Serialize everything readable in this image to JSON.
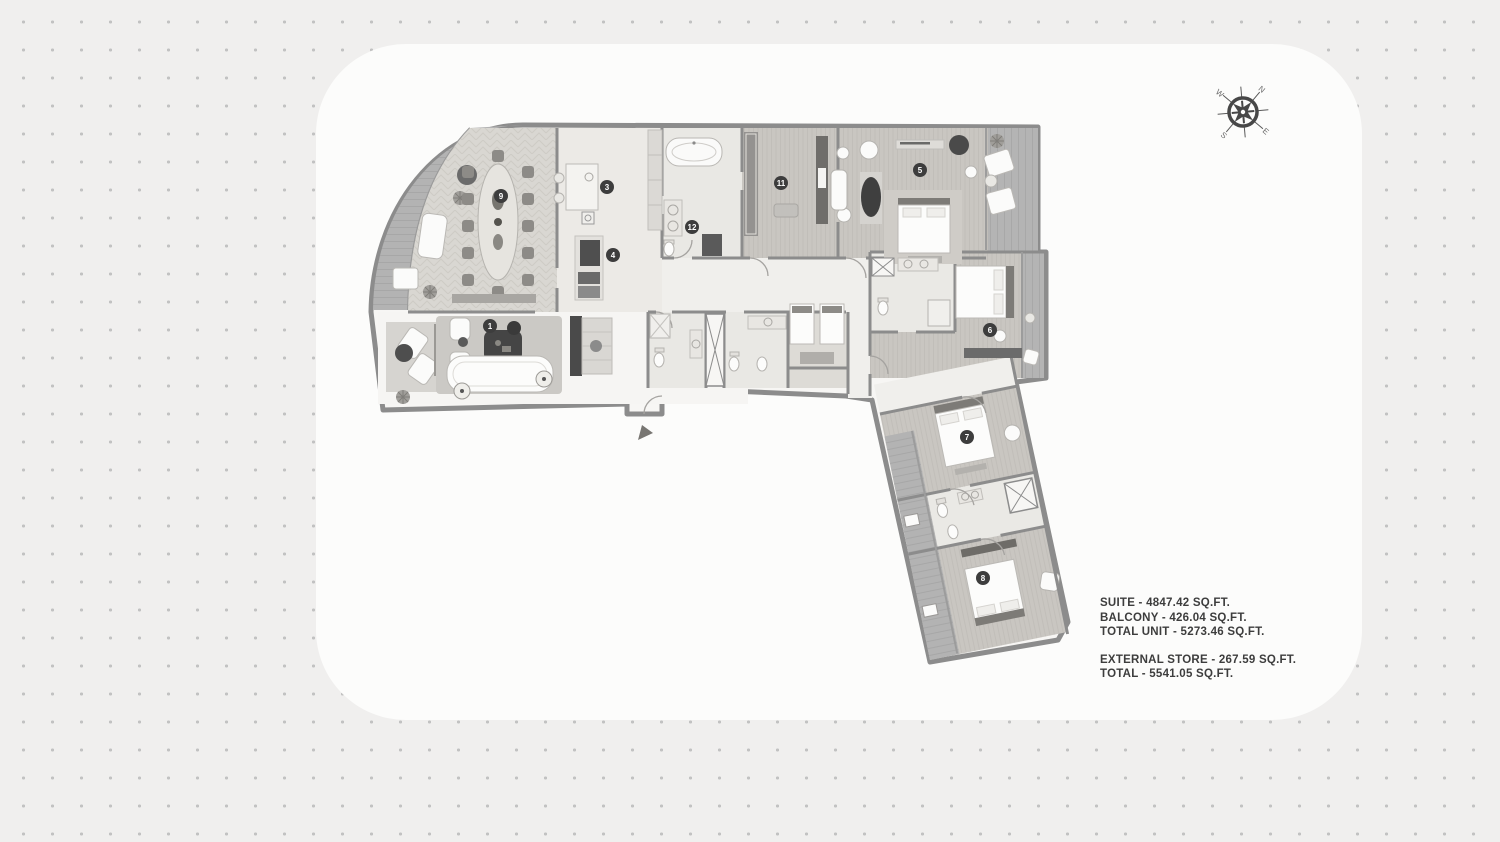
{
  "compass": {
    "n": "N",
    "e": "E",
    "s": "S",
    "w": "W"
  },
  "markers": {
    "m1": {
      "label": "1",
      "room": "living-room"
    },
    "m3": {
      "label": "3",
      "room": "kitchen"
    },
    "m4": {
      "label": "4",
      "room": "pantry"
    },
    "m5": {
      "label": "5",
      "room": "master-bedroom"
    },
    "m6": {
      "label": "6",
      "room": "bedroom-6"
    },
    "m7": {
      "label": "7",
      "room": "bedroom-7"
    },
    "m8": {
      "label": "8",
      "room": "bedroom-8"
    },
    "m9": {
      "label": "9",
      "room": "dining-room"
    },
    "m11": {
      "label": "11",
      "room": "dressing-room"
    },
    "m12": {
      "label": "12",
      "room": "bathroom"
    }
  },
  "stats": {
    "lines": [
      "SUITE -  4847.42 SQ.FT.",
      "BALCONY -  426.04 SQ.FT.",
      "TOTAL UNIT -  5273.46 SQ.FT.",
      "EXTERNAL STORE -  267.59 SQ.FT.",
      "TOTAL -  5541.05 SQ.FT."
    ]
  },
  "colors": {
    "background": "#f0efee",
    "dots": "#c2c2c2",
    "plan_backdrop": "#fcfcfb",
    "walls": "#8c8c8c",
    "deck": "#b3b3b3",
    "wood_floor": "#c9c6c1",
    "tile_floor": "#ebeae6",
    "living_floor": "#f6f5f3",
    "dark_furniture": "#4a4a4a",
    "marker_fill": "#3d3d3d",
    "text": "#3d3d3d"
  }
}
